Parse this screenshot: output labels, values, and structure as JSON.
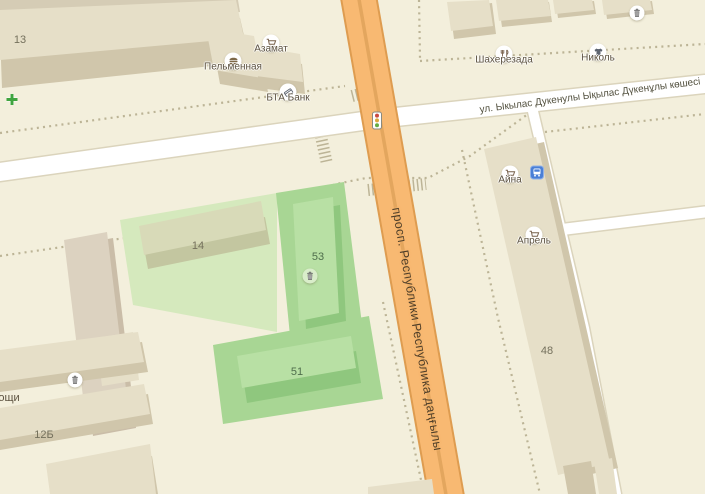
{
  "app": {
    "title": "Карта"
  },
  "colors": {
    "bg": "#f3efdc",
    "road_fill": "#f8b972",
    "road_casing": "#de9c50",
    "road_median": "#e3a65e",
    "street_fill": "#ffffff",
    "street_casing": "#dbd4bc",
    "dots": "#bcb496",
    "green_wash": "#d5e9bd",
    "green_zone": "#a8d694",
    "green_bldg_roof": "#b8e0a4",
    "green_bldg_side": "#8fc77e",
    "bldg_roof": "#e6dfc8",
    "bldg_side": "#d0c6ab",
    "bldg_band": "#d5ccb5",
    "bldg14_roof": "#d8dab8",
    "bldg14_side": "#c3c6a0",
    "taupe_roof": "#dcd2c0",
    "taupe_side": "#cabda8",
    "poi_label": "#5c5240",
    "road_label": "#4f3e28",
    "street_label": "#52503e",
    "num_label": "#74705c",
    "green_num": "#4f6e4c",
    "bus_blue": "#4a7fd6",
    "plus_green": "#3fa43f"
  },
  "streets": {
    "main_road_name_ru": "просп. Республики",
    "main_road_name_kk": "Республика даңғылы",
    "cross_street_name": "ул. Ыкылас Дукенулы Ықылас Дүкенұлы көшесі"
  },
  "street_labels": [
    {
      "text": "ул. Ыкылас Дукенулы Ықылас Дүкенұлы көшесі",
      "x": 590,
      "y": 96,
      "rotate": -7.3,
      "kind": "street"
    },
    {
      "text": "просп. Республики",
      "x": 406,
      "y": 264,
      "rotate": 80,
      "kind": "road"
    },
    {
      "text": "Республика даңғылы",
      "x": 427,
      "y": 387,
      "rotate": 80,
      "kind": "road"
    }
  ],
  "building_labels": [
    {
      "text": "13",
      "x": 20,
      "y": 40,
      "color_key": "num_label"
    },
    {
      "text": "14",
      "x": 198,
      "y": 246,
      "color_key": "num_label"
    },
    {
      "text": "53",
      "x": 318,
      "y": 257,
      "color_key": "green_num"
    },
    {
      "text": "51",
      "x": 297,
      "y": 372,
      "color_key": "green_num"
    },
    {
      "text": "48",
      "x": 547,
      "y": 351,
      "color_key": "num_label"
    },
    {
      "text": "12Б",
      "x": 44,
      "y": 435,
      "color_key": "num_label"
    },
    {
      "text": "ощи",
      "x": 9,
      "y": 398,
      "color_key": "poi_label"
    }
  ],
  "pois": [
    {
      "name": "Пельменная",
      "icon": "burger",
      "x": 233,
      "y": 61
    },
    {
      "name": "Азамат",
      "icon": "cart",
      "x": 271,
      "y": 43
    },
    {
      "name": "БТА Банк",
      "icon": "bank-card",
      "x": 288,
      "y": 92
    },
    {
      "name": "Шахерезада",
      "icon": "restaurant",
      "x": 504,
      "y": 54
    },
    {
      "name": "Николь",
      "icon": "clothes",
      "x": 598,
      "y": 52
    },
    {
      "name": "Айна",
      "icon": "cart",
      "x": 510,
      "y": 174
    },
    {
      "name": "Апрель",
      "icon": "cart",
      "x": 534,
      "y": 235
    }
  ],
  "markers": [
    {
      "icon": "trash",
      "x": 637,
      "y": 13
    },
    {
      "icon": "trash",
      "x": 310,
      "y": 276,
      "bg": "#d9edca"
    },
    {
      "icon": "trash",
      "x": 75,
      "y": 380
    },
    {
      "icon": "traffic-light",
      "x": 377,
      "y": 123
    },
    {
      "icon": "bus-stop",
      "x": 537,
      "y": 175
    },
    {
      "icon": "plus",
      "x": 12,
      "y": 101
    }
  ]
}
